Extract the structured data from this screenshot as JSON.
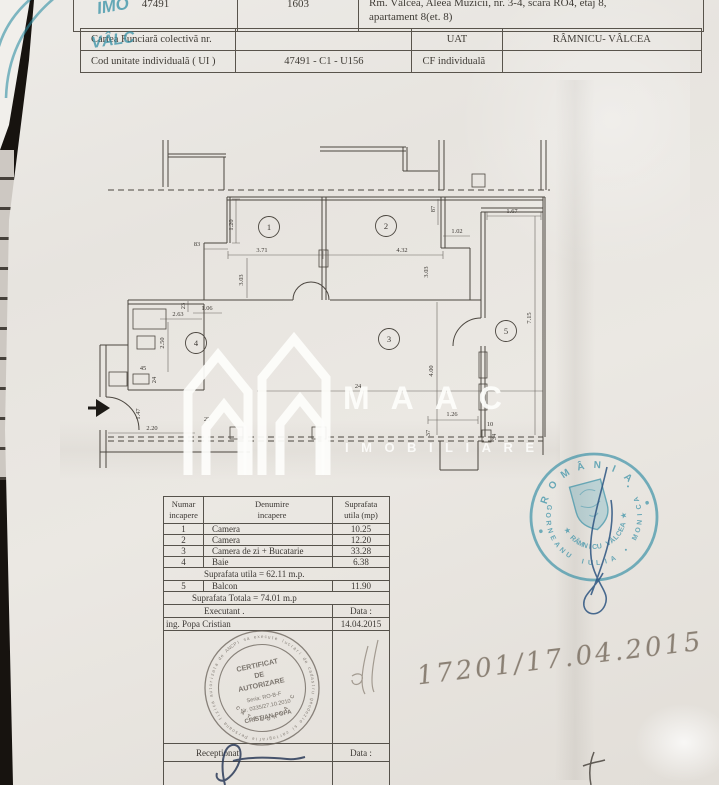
{
  "document": {
    "header_table1": {
      "cad_number": "47491",
      "top_number": "1603",
      "address_line1": "Rm. Vâlcea, Aleea Muzicii, nr. 3-4, scara RO4, etaj 8,",
      "address_line2": "apartament 8(et. 8)"
    },
    "header_table2": {
      "cf_label": "Cartea Funciară colectivă nr.",
      "uat_label": "UAT",
      "uat_value": "RÂMNICU- VÂLCEA",
      "ui_label": "Cod unitate individuală ( UI )",
      "ui_value": "47491 - C1 - U156",
      "cf_individual_label": "CF individuală"
    }
  },
  "floor_plan": {
    "rooms": [
      {
        "num": "1",
        "x": 269,
        "y": 227
      },
      {
        "num": "2",
        "x": 386,
        "y": 226
      },
      {
        "num": "3",
        "x": 389,
        "y": 339
      },
      {
        "num": "4",
        "x": 196,
        "y": 343
      },
      {
        "num": "5",
        "x": 506,
        "y": 331
      }
    ],
    "dimensions": [
      {
        "t": "83",
        "x": 197,
        "y": 246,
        "r": 0
      },
      {
        "t": "1.20",
        "x": 233,
        "y": 225,
        "r": -90
      },
      {
        "t": "3.71",
        "x": 262,
        "y": 252,
        "r": 0
      },
      {
        "t": "4.32",
        "x": 402,
        "y": 252,
        "r": 0
      },
      {
        "t": "3.03",
        "x": 243,
        "y": 280,
        "r": -90
      },
      {
        "t": "3.03",
        "x": 428,
        "y": 272,
        "r": -90
      },
      {
        "t": "87",
        "x": 435,
        "y": 209,
        "r": -90
      },
      {
        "t": "1.02",
        "x": 457,
        "y": 233,
        "r": 0
      },
      {
        "t": "1.67",
        "x": 512,
        "y": 213,
        "r": 0
      },
      {
        "t": "7.15",
        "x": 531,
        "y": 318,
        "r": -90
      },
      {
        "t": "23",
        "x": 185,
        "y": 306,
        "r": -90
      },
      {
        "t": "2.63",
        "x": 178,
        "y": 316,
        "r": 0
      },
      {
        "t": "1.06",
        "x": 207,
        "y": 310,
        "r": 0
      },
      {
        "t": "2.50",
        "x": 164,
        "y": 343,
        "r": -90
      },
      {
        "t": "45",
        "x": 143,
        "y": 370,
        "r": 0
      },
      {
        "t": "24",
        "x": 156,
        "y": 380,
        "r": -90
      },
      {
        "t": "1.47",
        "x": 140,
        "y": 414,
        "r": -90
      },
      {
        "t": "2.20",
        "x": 152,
        "y": 430,
        "r": 0
      },
      {
        "t": "25",
        "x": 207,
        "y": 421,
        "r": 0
      },
      {
        "t": "24",
        "x": 358,
        "y": 388,
        "r": 0
      },
      {
        "t": "4.00",
        "x": 433,
        "y": 371,
        "r": -90
      },
      {
        "t": "1.26",
        "x": 452,
        "y": 416,
        "r": 0
      },
      {
        "t": "10",
        "x": 490,
        "y": 426,
        "r": 0
      },
      {
        "t": "34",
        "x": 496,
        "y": 437,
        "r": -90
      },
      {
        "t": "37",
        "x": 430,
        "y": 433,
        "r": -90
      }
    ]
  },
  "watermark": {
    "name": "MAAC",
    "subtitle": "IMOBILIARE"
  },
  "area_table": {
    "headers": [
      "Numar\nincapere",
      "Denumire\nincapere",
      "Suprafata\nutila (mp)"
    ],
    "rows": [
      [
        "1",
        "Camera",
        "10.25"
      ],
      [
        "2",
        "Camera",
        "12.20"
      ],
      [
        "3",
        "Camera de zi + Bucatarie",
        "33.28"
      ],
      [
        "4",
        "Baie",
        "6.38"
      ]
    ],
    "subtotal": "Suprafata utila = 62.11 m.p.",
    "balcony_row": [
      "5",
      "Balcon",
      "11.90"
    ],
    "total": "Suprafata Totala = 74.01 m.p",
    "executant_label": "Executant .",
    "executant_date_label": "Data :",
    "executant_name": "ing. Popa Cristian",
    "executant_date": "14.04.2015",
    "received_label": "Receptionat",
    "received_date_label": "Data :"
  },
  "cert_stamp": {
    "title1": "CERTIFICAT",
    "title2": "DE",
    "title3": "AUTORIZARE",
    "series": "Seria: RO-B-F",
    "number": "Nr. 0335/27.10.2010",
    "name": "CRISTIAN POPA",
    "ring_text": "Persoana fizica autorizata de ANCPI sa execute lucrari de cadastru geodezie si cartografie",
    "category": "CATEGORIA C"
  },
  "notary_stamp": {
    "country": "ROMÂNIA",
    "name_arc": "GORNEANU IULIA • MONICA •",
    "city_arc": "★ RÂMNICU VÂLCEA ★"
  },
  "handwriting": {
    "registration_number": "17201/17.04.2015"
  },
  "corner_stamp": {
    "fragment1": "IMO",
    "fragment2": "VÂLC"
  },
  "colors": {
    "stamp_blue": "#2f8ea4",
    "ink_blue": "#2b5480",
    "pencil": "#8b8175"
  }
}
